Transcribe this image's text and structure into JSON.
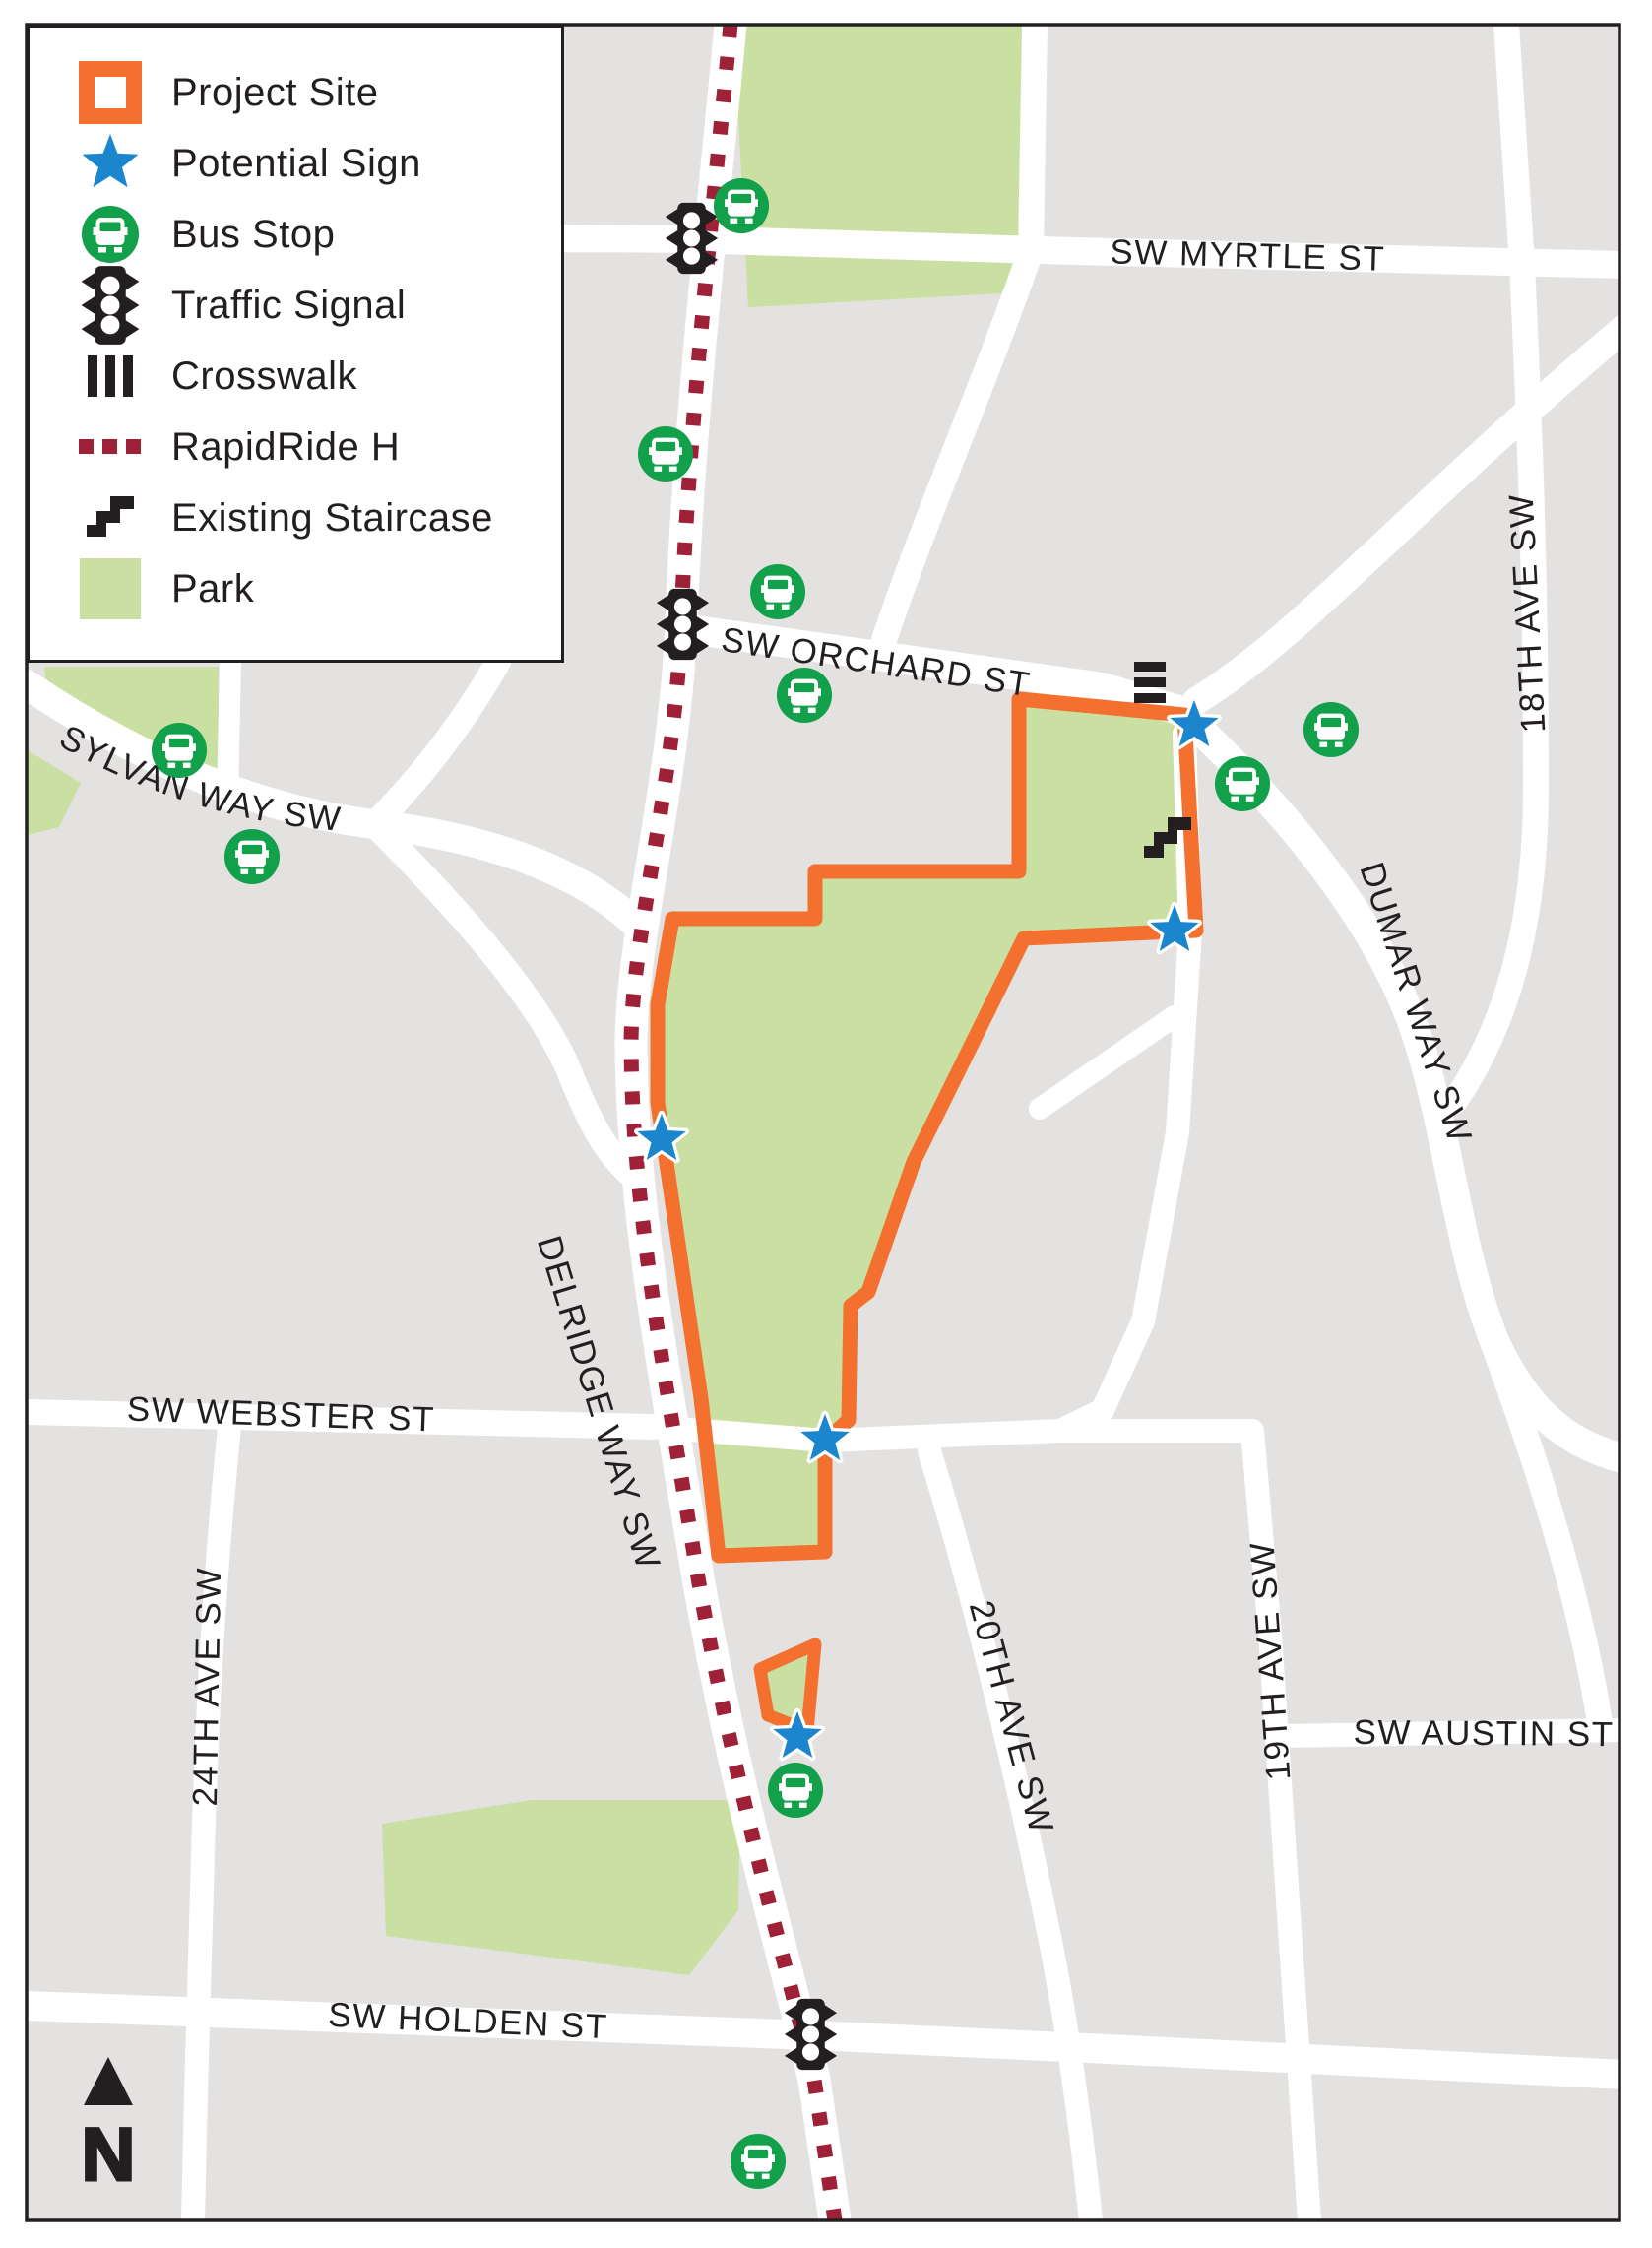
{
  "legend": {
    "items": [
      {
        "icon": "project-site-swatch",
        "label": "Project Site"
      },
      {
        "icon": "potential-sign-star",
        "label": "Potential Sign"
      },
      {
        "icon": "bus-stop",
        "label": "Bus Stop"
      },
      {
        "icon": "traffic-signal",
        "label": "Traffic Signal"
      },
      {
        "icon": "crosswalk",
        "label": "Crosswalk"
      },
      {
        "icon": "rapidride-h-line",
        "label": "RapidRide H"
      },
      {
        "icon": "existing-staircase",
        "label": "Existing Staircase"
      },
      {
        "icon": "park-swatch",
        "label": "Park"
      }
    ]
  },
  "map": {
    "street_labels": {
      "sw_myrtle_st": "SW MYRTLE ST",
      "sw_orchard_st": "SW ORCHARD ST",
      "sylvan_way_sw": "SYLVAN WAY SW",
      "delridge_way_sw": "DELRIDGE WAY SW",
      "sw_webster_st": "SW WEBSTER ST",
      "twentyfourth_ave_sw": "24TH AVE SW",
      "sw_holden_st": "SW HOLDEN ST",
      "twentieth_ave_sw": "20TH AVE SW",
      "nineteenth_ave_sw": "19TH AVE SW",
      "sw_austin_st": "SW AUSTIN ST",
      "dumar_way_sw": "DUMAR WAY SW",
      "eighteenth_ave_sw": "18TH AVE SW"
    },
    "north_arrow_label": "N"
  },
  "colors": {
    "project_site_orange": "#f3702f",
    "potential_sign_blue": "#1b86ce",
    "bus_stop_green": "#12a04b",
    "rapidride_maroon": "#9e2138",
    "park_green": "#c9e0a2",
    "road_white": "#ffffff",
    "map_background_gray": "#e3e2e0",
    "ink_black": "#231f20"
  }
}
